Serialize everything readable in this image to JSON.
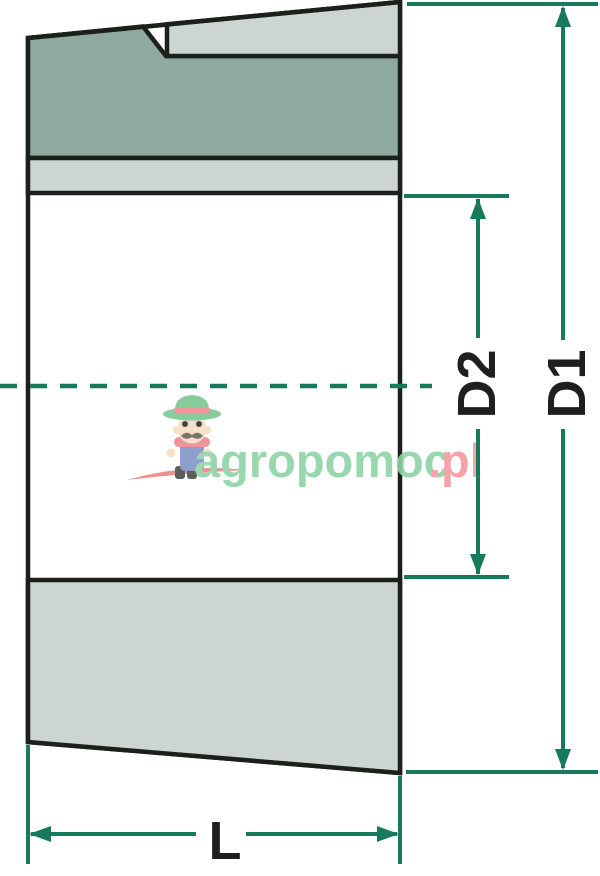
{
  "diagram": {
    "labels": {
      "outer_diameter": "D1",
      "inner_diameter": "D2",
      "length": "L"
    },
    "colors": {
      "outline": "#1b201b",
      "dimension_line": "#177a5b",
      "fill_dark": "#8ea9a0",
      "fill_light": "#ccd5d1",
      "label_text": "#1f1f1f",
      "background": "#ffffff"
    }
  },
  "watermark": {
    "brand": "agropomoc",
    "tld": ".pl",
    "brand_color": "#8fd3a6",
    "tld_color": "#f4989f"
  }
}
